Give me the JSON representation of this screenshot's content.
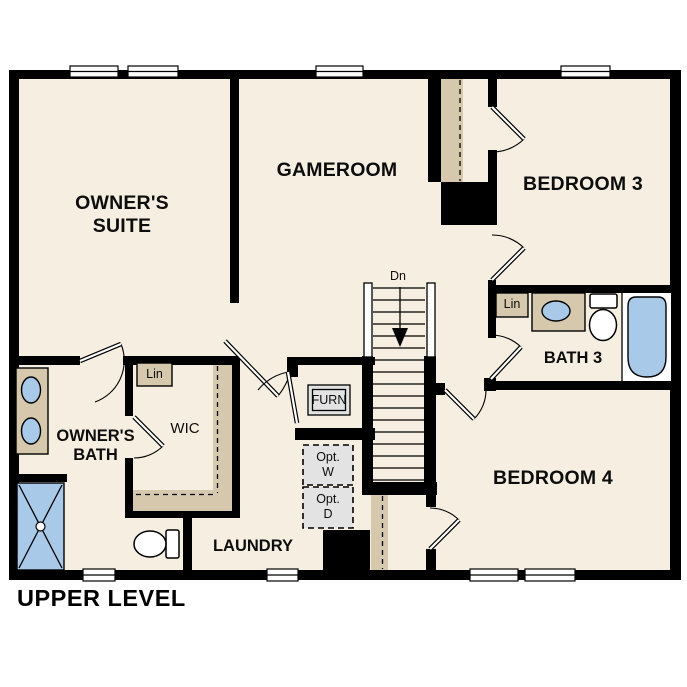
{
  "title": "UPPER LEVEL",
  "rooms": {
    "owners_suite": "OWNER'S\nSUITE",
    "gameroom": "GAMEROOM",
    "bedroom3": "BEDROOM 3",
    "bath3": "BATH 3",
    "bedroom4": "BEDROOM 4",
    "owners_bath": "OWNER'S\nBATH",
    "wic": "WIC",
    "laundry": "LAUNDRY"
  },
  "labels": {
    "stairs_direction": "Dn",
    "linen_wic": "Lin",
    "linen_bath3": "Lin",
    "furnace": "FURN",
    "optional_washer": "Opt.\nW",
    "optional_dryer": "Opt.\nD"
  },
  "colors": {
    "wall": "#000000",
    "floor": "#f5eee1",
    "cabinetry": "#d5c8ad",
    "fixture_blue": "#a9c9e9",
    "appliance_gray": "#e3e3e3"
  }
}
